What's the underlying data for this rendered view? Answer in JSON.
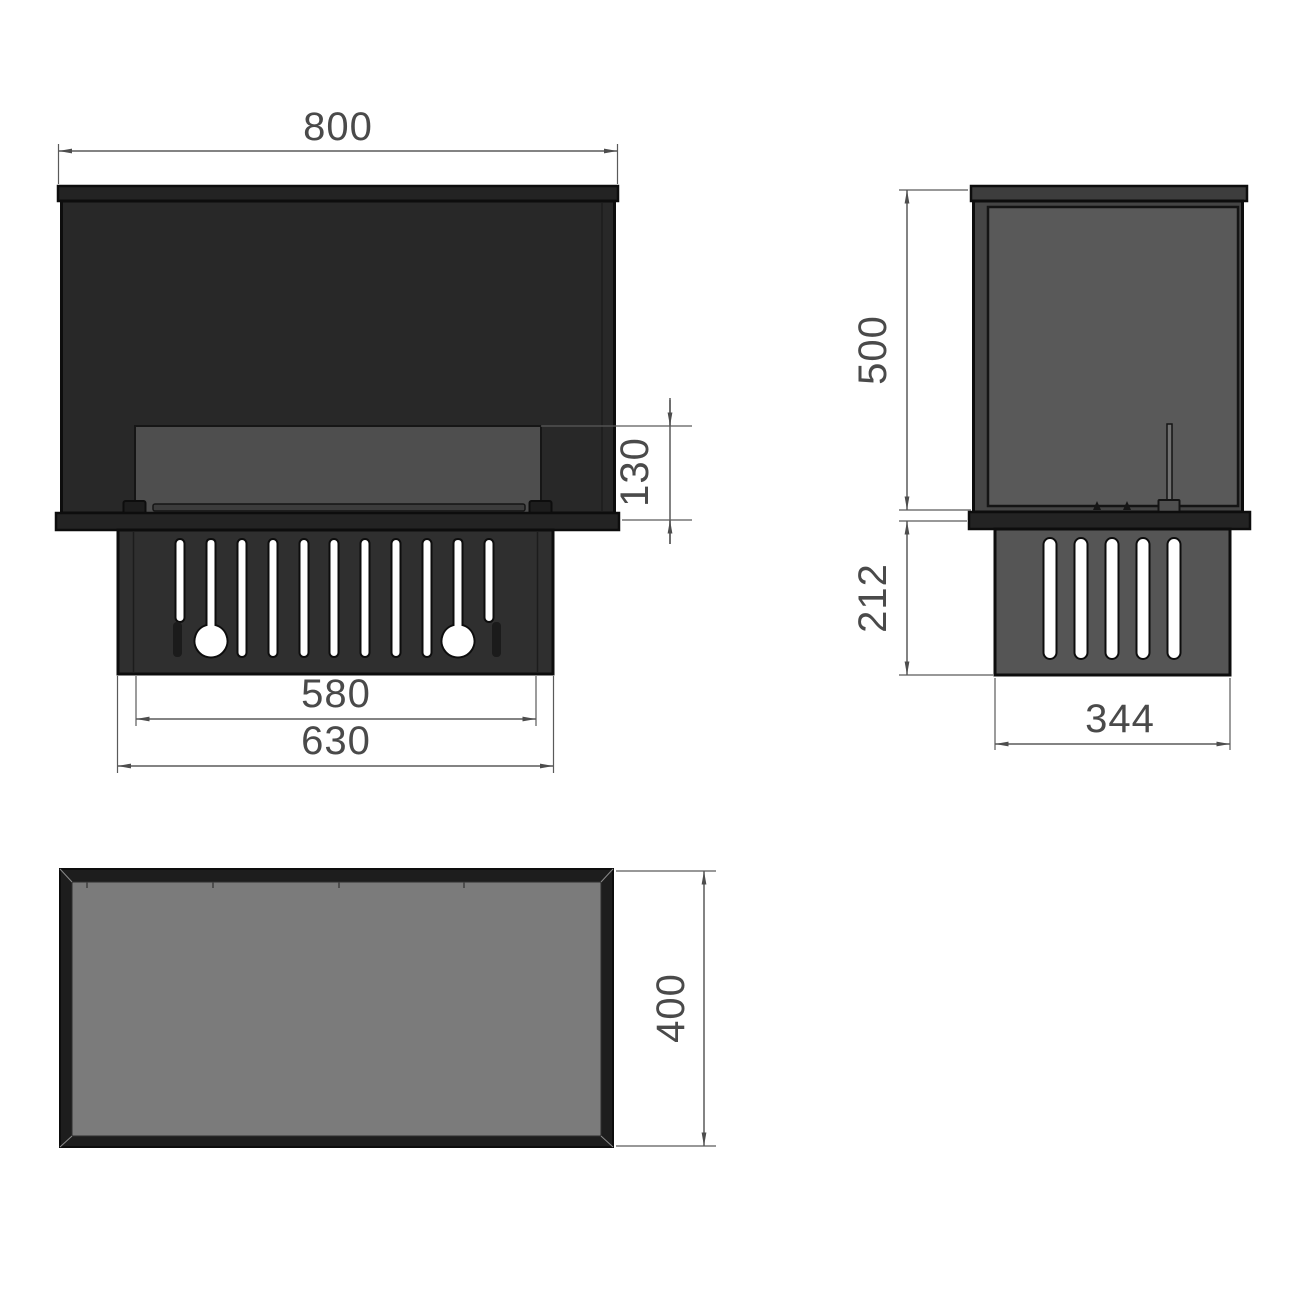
{
  "drawing": {
    "type": "technical-dimension-drawing",
    "subject": "built-in bio fireplace insert, three orthographic views",
    "views": {
      "front": "front-view",
      "side": "side-view",
      "top": "top-view"
    },
    "unit_labels": {
      "front_width": "800",
      "burner_opening_height": "130",
      "base_inner_width": "580",
      "base_outer_width": "630",
      "body_height": "500",
      "base_height": "212",
      "base_depth": "344",
      "body_depth": "400"
    },
    "colors": {
      "front_body": "#282828",
      "front_cap": "#232323",
      "front_window": "#4e4e4e",
      "front_base": "#2f2f2f",
      "side_body_edge": "#454545",
      "side_panel": "#595959",
      "side_cap": "#3d3d3d",
      "side_base": "#555555",
      "top_border": "#1d1d1d",
      "top_fill": "#7b7b7b",
      "outline": "#0d0d0d",
      "dimension_line": "#5a5a5a",
      "dimension_text": "#4a4a4a",
      "background": "#ffffff"
    }
  }
}
